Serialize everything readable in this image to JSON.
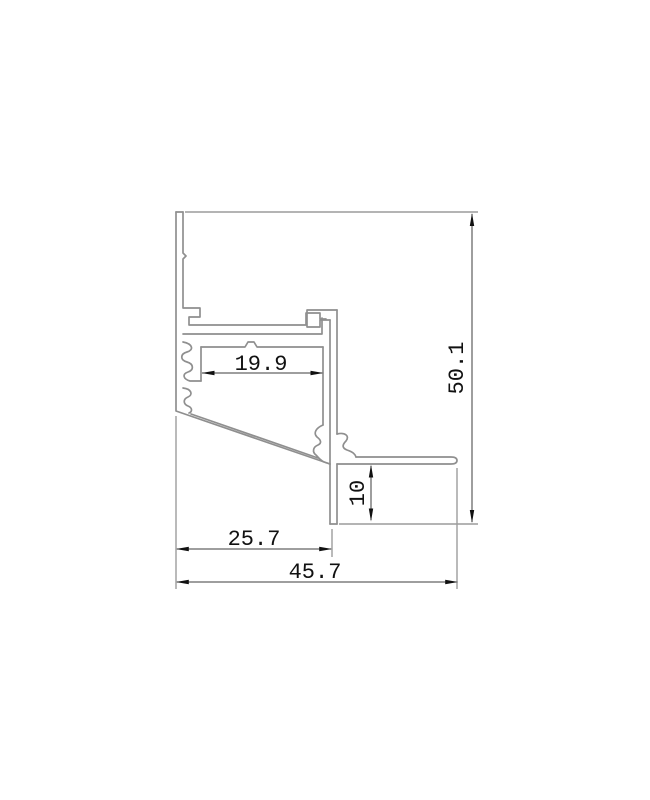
{
  "drawing": {
    "kind": "aluminum-led-profile-cross-section",
    "colors": {
      "background": "#ffffff",
      "profile_line": "#8f8f8f",
      "extension_line": "#9c9c9c",
      "dimension_line": "#3c3c3c",
      "arrow": "#111111",
      "text": "#111111"
    },
    "dimensions": {
      "slot_width": {
        "label": "19.9",
        "value": 19.9,
        "orientation": "horizontal"
      },
      "total_height": {
        "label": "50.1",
        "value": 50.1,
        "orientation": "vertical"
      },
      "leg_height": {
        "label": "10",
        "value": 10,
        "orientation": "vertical"
      },
      "left_width": {
        "label": "25.7",
        "value": 25.7,
        "orientation": "horizontal"
      },
      "total_width": {
        "label": "45.7",
        "value": 45.7,
        "orientation": "horizontal"
      }
    }
  }
}
